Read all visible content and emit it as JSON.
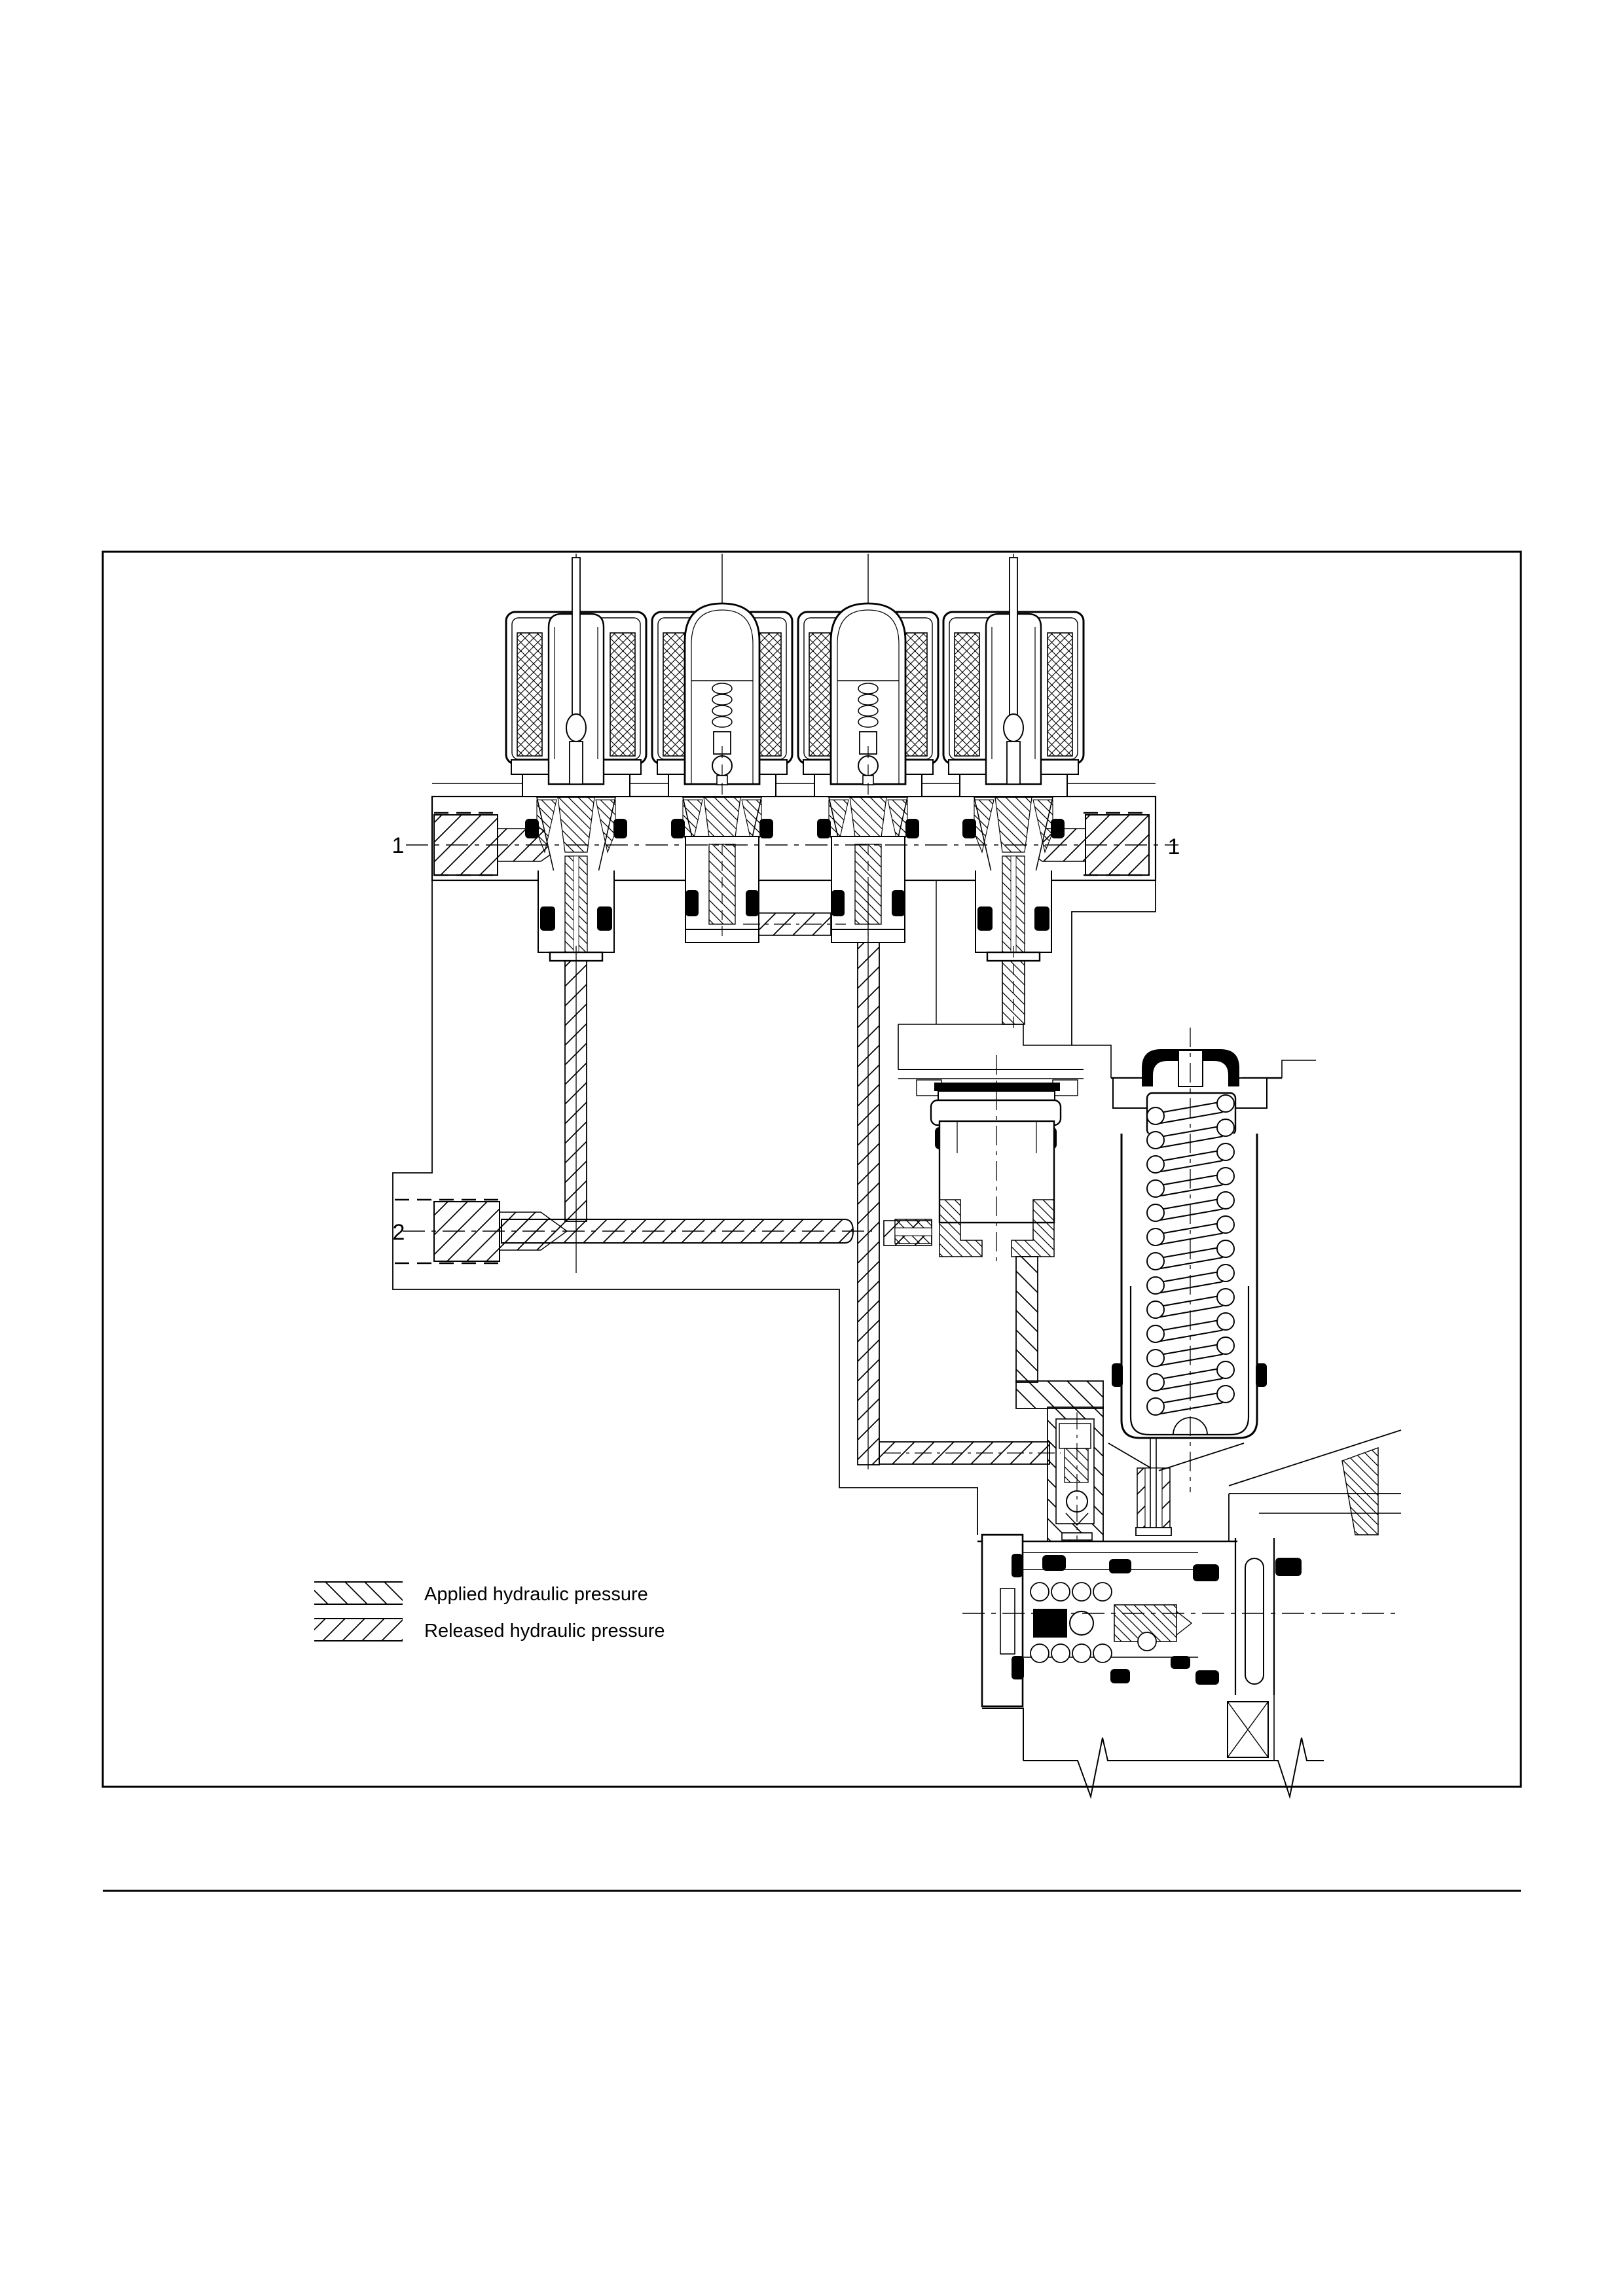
{
  "figure": {
    "type": "hydraulic-pressure-cross-section-diagram",
    "callouts": {
      "port1_left": "1",
      "port1_right": "1",
      "port2": "2"
    },
    "legend": {
      "applied": {
        "label": "Applied hydraulic pressure",
        "hatch": "backslash-diagonal"
      },
      "released": {
        "label": "Released hydraulic pressure",
        "hatch": "forward-diagonal"
      }
    },
    "colors": {
      "ink": "#000000",
      "paper": "#ffffff"
    }
  }
}
